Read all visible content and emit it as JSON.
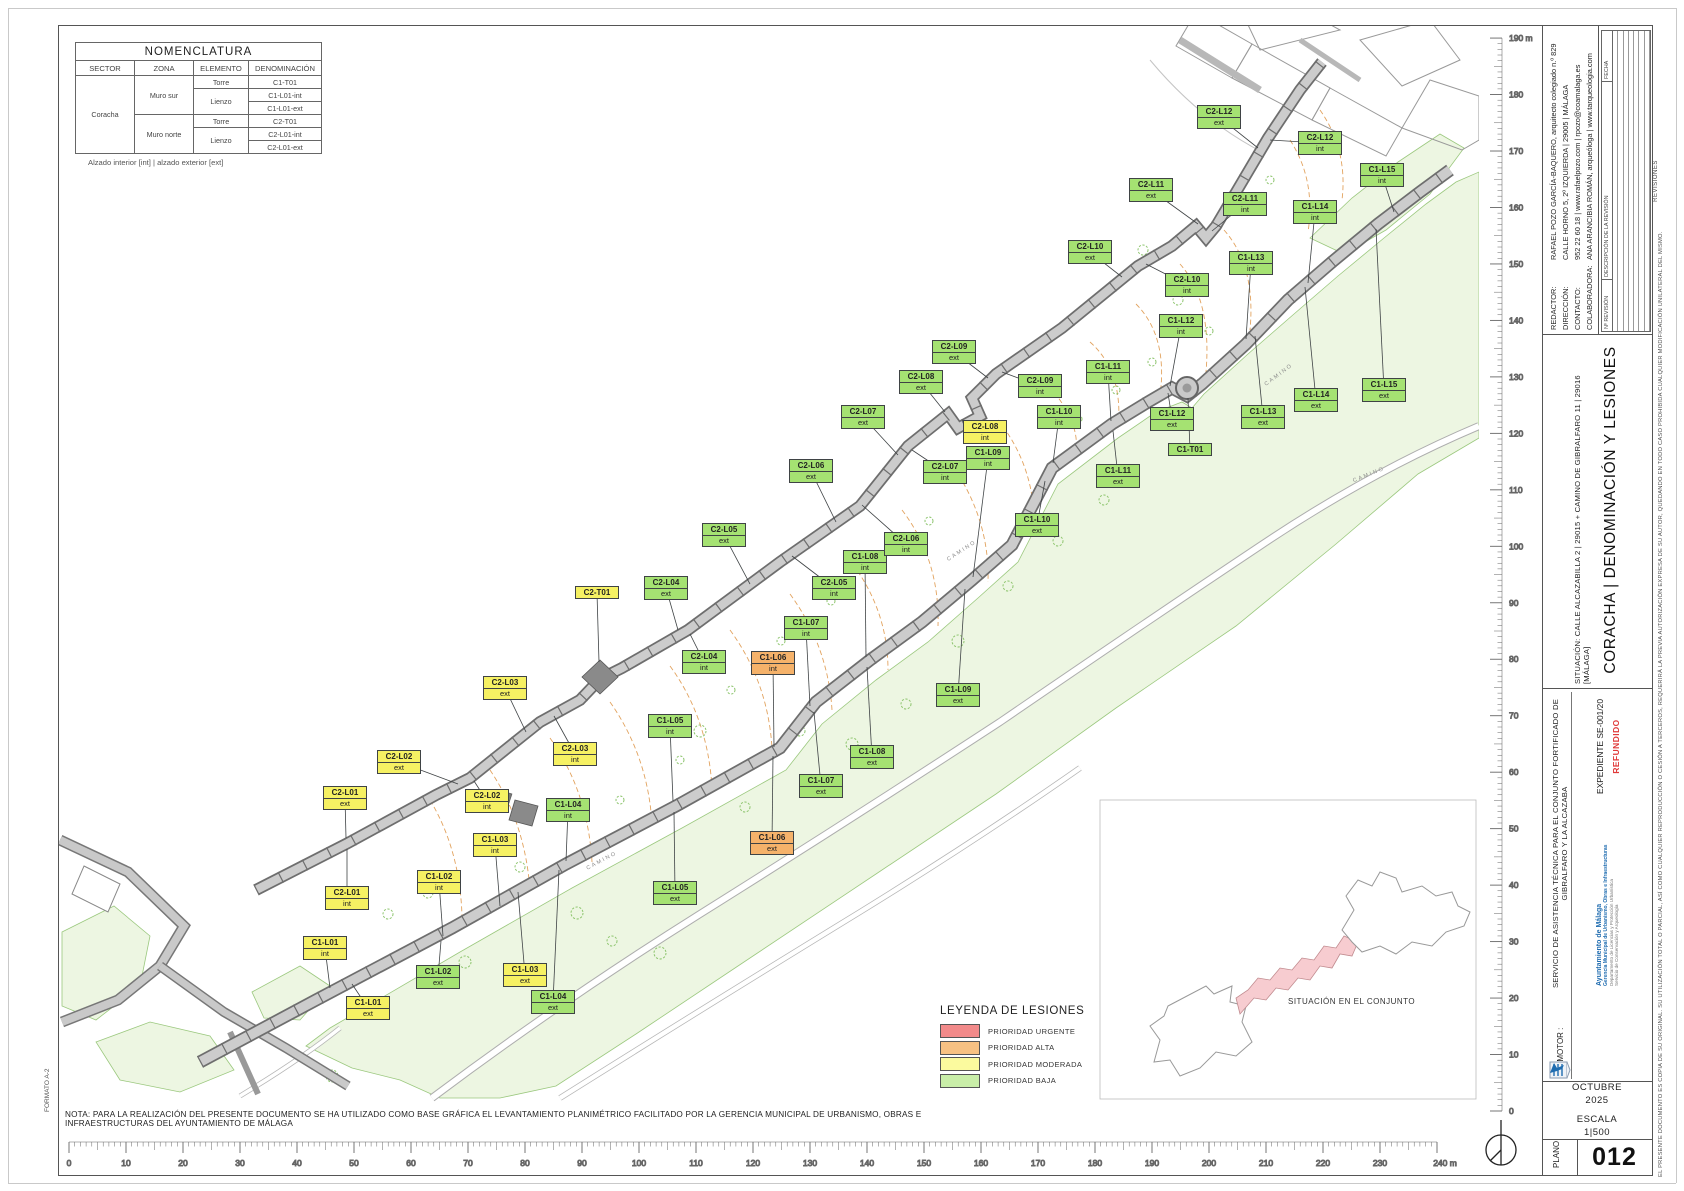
{
  "page": {
    "note": "NOTA: PARA LA REALIZACIÓN DEL PRESENTE DOCUMENTO SE HA UTILIZADO COMO BASE GRÁFICA EL LEVANTAMIENTO PLANIMÉTRICO FACILITADO POR LA GERENCIA MUNICIPAL DE URBANISMO, OBRAS E INFRAESTRUCTURAS DEL AYUNTAMIENTO DE MÁLAGA",
    "formato": "FORMATO A-2"
  },
  "nomenclatura": {
    "title": "NOMENCLATURA",
    "headers": [
      "SECTOR",
      "ZONA",
      "ELEMENTO",
      "DENOMINACIÓN"
    ],
    "sector": "Coracha",
    "zona_sur": "Muro sur",
    "zona_norte": "Muro norte",
    "torre": "Torre",
    "lienzo": "Lienzo",
    "torre2": "Torre",
    "lienzo2": "Lienzo",
    "d": [
      "C1-T01",
      "C1-L01-int",
      "C1-L01-ext",
      "C2-T01",
      "C2-L01-int",
      "C2-L01-ext"
    ],
    "caption": "Alzado interior [int] | alzado exterior [ext]"
  },
  "legend": {
    "title": "LEYENDA DE LESIONES",
    "items": [
      {
        "label": "PRIORIDAD URGENTE",
        "color": "#f28a8a"
      },
      {
        "label": "PRIORIDAD ALTA",
        "color": "#f7c183"
      },
      {
        "label": "PRIORIDAD MODERADA",
        "color": "#fbfa9e"
      },
      {
        "label": "PRIORIDAD BAJA",
        "color": "#c9eea8"
      }
    ],
    "label_colors": {
      "urgente": "#f28585",
      "alta": "#f5b26a",
      "moderada": "#f6f163",
      "baja": "#a5e272"
    }
  },
  "map": {
    "situacion_inset": "SITUACIÓN EN EL CONJUNTO",
    "scalebar": {
      "min": 0,
      "max": 240,
      "step": 10,
      "unit": "m"
    },
    "vruler": {
      "min": 0,
      "max": 190,
      "step": 10,
      "unit": "m"
    },
    "texts": [
      {
        "t": "CAMINO",
        "x": 585,
        "y": 858,
        "r": -28
      },
      {
        "t": "CAMINO",
        "x": 945,
        "y": 548,
        "r": -33
      },
      {
        "t": "CAMINO",
        "x": 1262,
        "y": 372,
        "r": -37
      },
      {
        "t": "CAMINO",
        "x": 1352,
        "y": 472,
        "r": -22
      }
    ],
    "labels": [
      {
        "id": "C1-L01",
        "sub": "int",
        "x": 325,
        "y": 948,
        "p": "moderada",
        "tx": 330,
        "ty": 988
      },
      {
        "id": "C1-L01",
        "sub": "ext",
        "x": 368,
        "y": 1008,
        "p": "moderada",
        "tx": 352,
        "ty": 984
      },
      {
        "id": "C1-L02",
        "sub": "int",
        "x": 439,
        "y": 882,
        "p": "moderada",
        "tx": 443,
        "ty": 936
      },
      {
        "id": "C1-L02",
        "sub": "ext",
        "x": 438,
        "y": 977,
        "p": "baja",
        "tx": 441,
        "ty": 941
      },
      {
        "id": "C1-L03",
        "sub": "int",
        "x": 495,
        "y": 845,
        "p": "moderada",
        "tx": 500,
        "ty": 906
      },
      {
        "id": "C1-L03",
        "sub": "ext",
        "x": 525,
        "y": 975,
        "p": "moderada",
        "tx": 518,
        "ty": 892
      },
      {
        "id": "C1-L04",
        "sub": "int",
        "x": 568,
        "y": 810,
        "p": "baja",
        "tx": 566,
        "ty": 861
      },
      {
        "id": "C1-L04",
        "sub": "ext",
        "x": 553,
        "y": 1002,
        "p": "baja",
        "tx": 559,
        "ty": 870
      },
      {
        "id": "C1-L05",
        "sub": "int",
        "x": 670,
        "y": 726,
        "p": "baja",
        "tx": 673,
        "ty": 801
      },
      {
        "id": "C1-L05",
        "sub": "ext",
        "x": 675,
        "y": 893,
        "p": "baja",
        "tx": 674,
        "ty": 812
      },
      {
        "id": "C1-L06",
        "sub": "int",
        "x": 773,
        "y": 663,
        "p": "alta",
        "tx": 774,
        "ty": 747
      },
      {
        "id": "C1-L06",
        "sub": "ext",
        "x": 772,
        "y": 843,
        "p": "alta",
        "tx": 773,
        "ty": 756
      },
      {
        "id": "C1-L07",
        "sub": "int",
        "x": 806,
        "y": 628,
        "p": "baja",
        "tx": 810,
        "ty": 706
      },
      {
        "id": "C1-L07",
        "sub": "ext",
        "x": 821,
        "y": 786,
        "p": "baja",
        "tx": 814,
        "ty": 712
      },
      {
        "id": "C1-L08",
        "sub": "int",
        "x": 865,
        "y": 562,
        "p": "baja",
        "tx": 866,
        "ty": 657
      },
      {
        "id": "C1-L08",
        "sub": "ext",
        "x": 872,
        "y": 757,
        "p": "baja",
        "tx": 867,
        "ty": 667
      },
      {
        "id": "C1-L09",
        "sub": "int",
        "x": 988,
        "y": 458,
        "p": "baja",
        "tx": 973,
        "ty": 577
      },
      {
        "id": "C1-L09",
        "sub": "ext",
        "x": 958,
        "y": 695,
        "p": "baja",
        "tx": 965,
        "ty": 589
      },
      {
        "id": "C1-L10",
        "sub": "int",
        "x": 1059,
        "y": 417,
        "p": "baja",
        "tx": 1053,
        "ty": 463
      },
      {
        "id": "C1-L10",
        "sub": "ext",
        "x": 1037,
        "y": 525,
        "p": "baja",
        "tx": 1045,
        "ty": 481
      },
      {
        "id": "C1-L11",
        "sub": "int",
        "x": 1108,
        "y": 372,
        "p": "baja",
        "tx": 1111,
        "ty": 421
      },
      {
        "id": "C1-L11",
        "sub": "ext",
        "x": 1118,
        "y": 476,
        "p": "baja",
        "tx": 1113,
        "ty": 431
      },
      {
        "id": "C1-L12",
        "sub": "int",
        "x": 1181,
        "y": 326,
        "p": "baja",
        "tx": 1170,
        "ty": 386
      },
      {
        "id": "C1-L12",
        "sub": "ext",
        "x": 1172,
        "y": 419,
        "p": "baja",
        "tx": 1168,
        "ty": 393
      },
      {
        "id": "C1-T01",
        "sub": "",
        "x": 1190,
        "y": 450,
        "p": "baja",
        "tx": 1188,
        "ty": 398
      },
      {
        "id": "C1-L13",
        "sub": "int",
        "x": 1251,
        "y": 263,
        "p": "baja",
        "tx": 1246,
        "ty": 339
      },
      {
        "id": "C1-L13",
        "sub": "ext",
        "x": 1263,
        "y": 417,
        "p": "baja",
        "tx": 1255,
        "ty": 336
      },
      {
        "id": "C1-L14",
        "sub": "int",
        "x": 1315,
        "y": 212,
        "p": "baja",
        "tx": 1308,
        "ty": 283
      },
      {
        "id": "C1-L14",
        "sub": "ext",
        "x": 1316,
        "y": 400,
        "p": "baja",
        "tx": 1305,
        "ty": 287
      },
      {
        "id": "C1-L15",
        "sub": "int",
        "x": 1382,
        "y": 175,
        "p": "baja",
        "tx": 1394,
        "ty": 212
      },
      {
        "id": "C1-L15",
        "sub": "ext",
        "x": 1384,
        "y": 390,
        "p": "baja",
        "tx": 1376,
        "ty": 229
      },
      {
        "id": "C2-L01",
        "sub": "ext",
        "x": 345,
        "y": 798,
        "p": "moderada",
        "tx": 346,
        "ty": 838
      },
      {
        "id": "C2-L01",
        "sub": "int",
        "x": 347,
        "y": 898,
        "p": "moderada",
        "tx": 347,
        "ty": 849
      },
      {
        "id": "C2-L02",
        "sub": "ext",
        "x": 399,
        "y": 762,
        "p": "moderada",
        "tx": 458,
        "ty": 784
      },
      {
        "id": "C2-L02",
        "sub": "int",
        "x": 487,
        "y": 801,
        "p": "moderada",
        "tx": 474,
        "ty": 781
      },
      {
        "id": "C2-L03",
        "sub": "ext",
        "x": 505,
        "y": 688,
        "p": "moderada",
        "tx": 526,
        "ty": 732
      },
      {
        "id": "C2-L03",
        "sub": "int",
        "x": 575,
        "y": 754,
        "p": "moderada",
        "tx": 554,
        "ty": 716
      },
      {
        "id": "C2-T01",
        "sub": "",
        "x": 597,
        "y": 593,
        "p": "moderada",
        "tx": 599,
        "ty": 662
      },
      {
        "id": "C2-L04",
        "sub": "ext",
        "x": 666,
        "y": 588,
        "p": "baja",
        "tx": 678,
        "ty": 630
      },
      {
        "id": "C2-L04",
        "sub": "int",
        "x": 704,
        "y": 662,
        "p": "baja",
        "tx": 690,
        "ty": 634
      },
      {
        "id": "C2-L05",
        "sub": "ext",
        "x": 724,
        "y": 535,
        "p": "baja",
        "tx": 750,
        "ty": 584
      },
      {
        "id": "C2-L05",
        "sub": "int",
        "x": 834,
        "y": 588,
        "p": "baja",
        "tx": 792,
        "ty": 556
      },
      {
        "id": "C2-L06",
        "sub": "ext",
        "x": 811,
        "y": 471,
        "p": "baja",
        "tx": 836,
        "ty": 522
      },
      {
        "id": "C2-L06",
        "sub": "int",
        "x": 906,
        "y": 544,
        "p": "baja",
        "tx": 862,
        "ty": 505
      },
      {
        "id": "C2-L07",
        "sub": "ext",
        "x": 863,
        "y": 417,
        "p": "baja",
        "tx": 898,
        "ty": 455
      },
      {
        "id": "C2-L07",
        "sub": "int",
        "x": 945,
        "y": 472,
        "p": "baja",
        "tx": 912,
        "ty": 450
      },
      {
        "id": "C2-L08",
        "sub": "ext",
        "x": 921,
        "y": 382,
        "p": "baja",
        "tx": 945,
        "ty": 412
      },
      {
        "id": "C2-L08",
        "sub": "int",
        "x": 985,
        "y": 432,
        "p": "moderada",
        "tx": 962,
        "ty": 420
      },
      {
        "id": "C2-L09",
        "sub": "ext",
        "x": 954,
        "y": 352,
        "p": "baja",
        "tx": 988,
        "ty": 378
      },
      {
        "id": "C2-L09",
        "sub": "int",
        "x": 1040,
        "y": 386,
        "p": "baja",
        "tx": 1002,
        "ty": 372
      },
      {
        "id": "C2-L10",
        "sub": "ext",
        "x": 1090,
        "y": 252,
        "p": "baja",
        "tx": 1122,
        "ty": 277
      },
      {
        "id": "C2-L10",
        "sub": "int",
        "x": 1187,
        "y": 285,
        "p": "baja",
        "tx": 1146,
        "ty": 264
      },
      {
        "id": "C2-L11",
        "sub": "ext",
        "x": 1151,
        "y": 190,
        "p": "baja",
        "tx": 1198,
        "ty": 224
      },
      {
        "id": "C2-L11",
        "sub": "int",
        "x": 1245,
        "y": 204,
        "p": "baja",
        "tx": 1212,
        "ty": 231
      },
      {
        "id": "C2-L12",
        "sub": "ext",
        "x": 1219,
        "y": 117,
        "p": "baja",
        "tx": 1258,
        "ty": 148
      },
      {
        "id": "C2-L12",
        "sub": "int",
        "x": 1320,
        "y": 143,
        "p": "baja",
        "tx": 1270,
        "ty": 140
      }
    ]
  },
  "titleblock": {
    "redactor": [
      {
        "k": "REDACTOR:",
        "v": "RAFAEL POZO GARCÍA-BAQUERO, arquitecto colegiado n.º 829"
      },
      {
        "k": "DIRECCIÓN:",
        "v": "CALLE HORNO 5, 2º IZQUIERDA | 29005 | MÁLAGA"
      },
      {
        "k": "CONTACTO:",
        "v": "952 22 60 18 | www.rafaelpozo.com | rpozo@coamalaga.es"
      },
      {
        "k": "COLABORADORA:",
        "v": "ANA ARANCIBIA ROMÁN, arqueóloga | www.tarqueologia.com"
      }
    ],
    "revisiones": {
      "headers": [
        "Nº REVISIÓN",
        "DESCRIPCIÓN DE LA REVISIÓN",
        "FECHA"
      ],
      "caption": "REVISIONES",
      "empty_rows": 7
    },
    "situacion": "SITUACIÓN: CALLE ALCAZABILLA 2 | 29015 + CAMINO DE GIBRALFARO 11 | 29016 [MÁLAGA]",
    "title": "CORACHA | DENOMINACIÓN Y LESIONES",
    "servicio": "SERVICIO DE ASISTENCIA TÉCNICA PARA EL CONJUNTO FORTIFICADO DE GIBRALFARO Y LA ALCAZABA",
    "promotor_label": "PROMOTOR :",
    "promotor": {
      "name": "Ayuntamiento de Málaga",
      "line1": "Gerencia Municipal de Urbanismo, Obras e Infraestructuras",
      "line2": "Departamento de Licencias y Protección Urbanística",
      "line3": "Servicio de Conservación y Arqueología"
    },
    "expediente": "EXPEDIENTE SE-001/20",
    "refundido": "REFUNDIDO",
    "refundido_color": "#e03a3a",
    "mes": "OCTUBRE",
    "anio": "2025",
    "escala_label": "ESCALA",
    "escala": "1|500",
    "plano_label": "PLANO",
    "plano": "012",
    "disclaimer": "EL PRESENTE DOCUMENTO ES COPIA DE SU ORIGINAL. SU UTILIZACIÓN TOTAL O PARCIAL, ASÍ COMO CUALQUIER REPRODUCCIÓN O CESIÓN A TERCEROS, REQUERIRÁ LA PREVIA AUTORIZACIÓN EXPRESA DE SU AUTOR, QUEDANDO EN TODO CASO PROHIBIDA CUALQUIER MODIFICACIÓN UNILATERAL DEL MISMO."
  }
}
